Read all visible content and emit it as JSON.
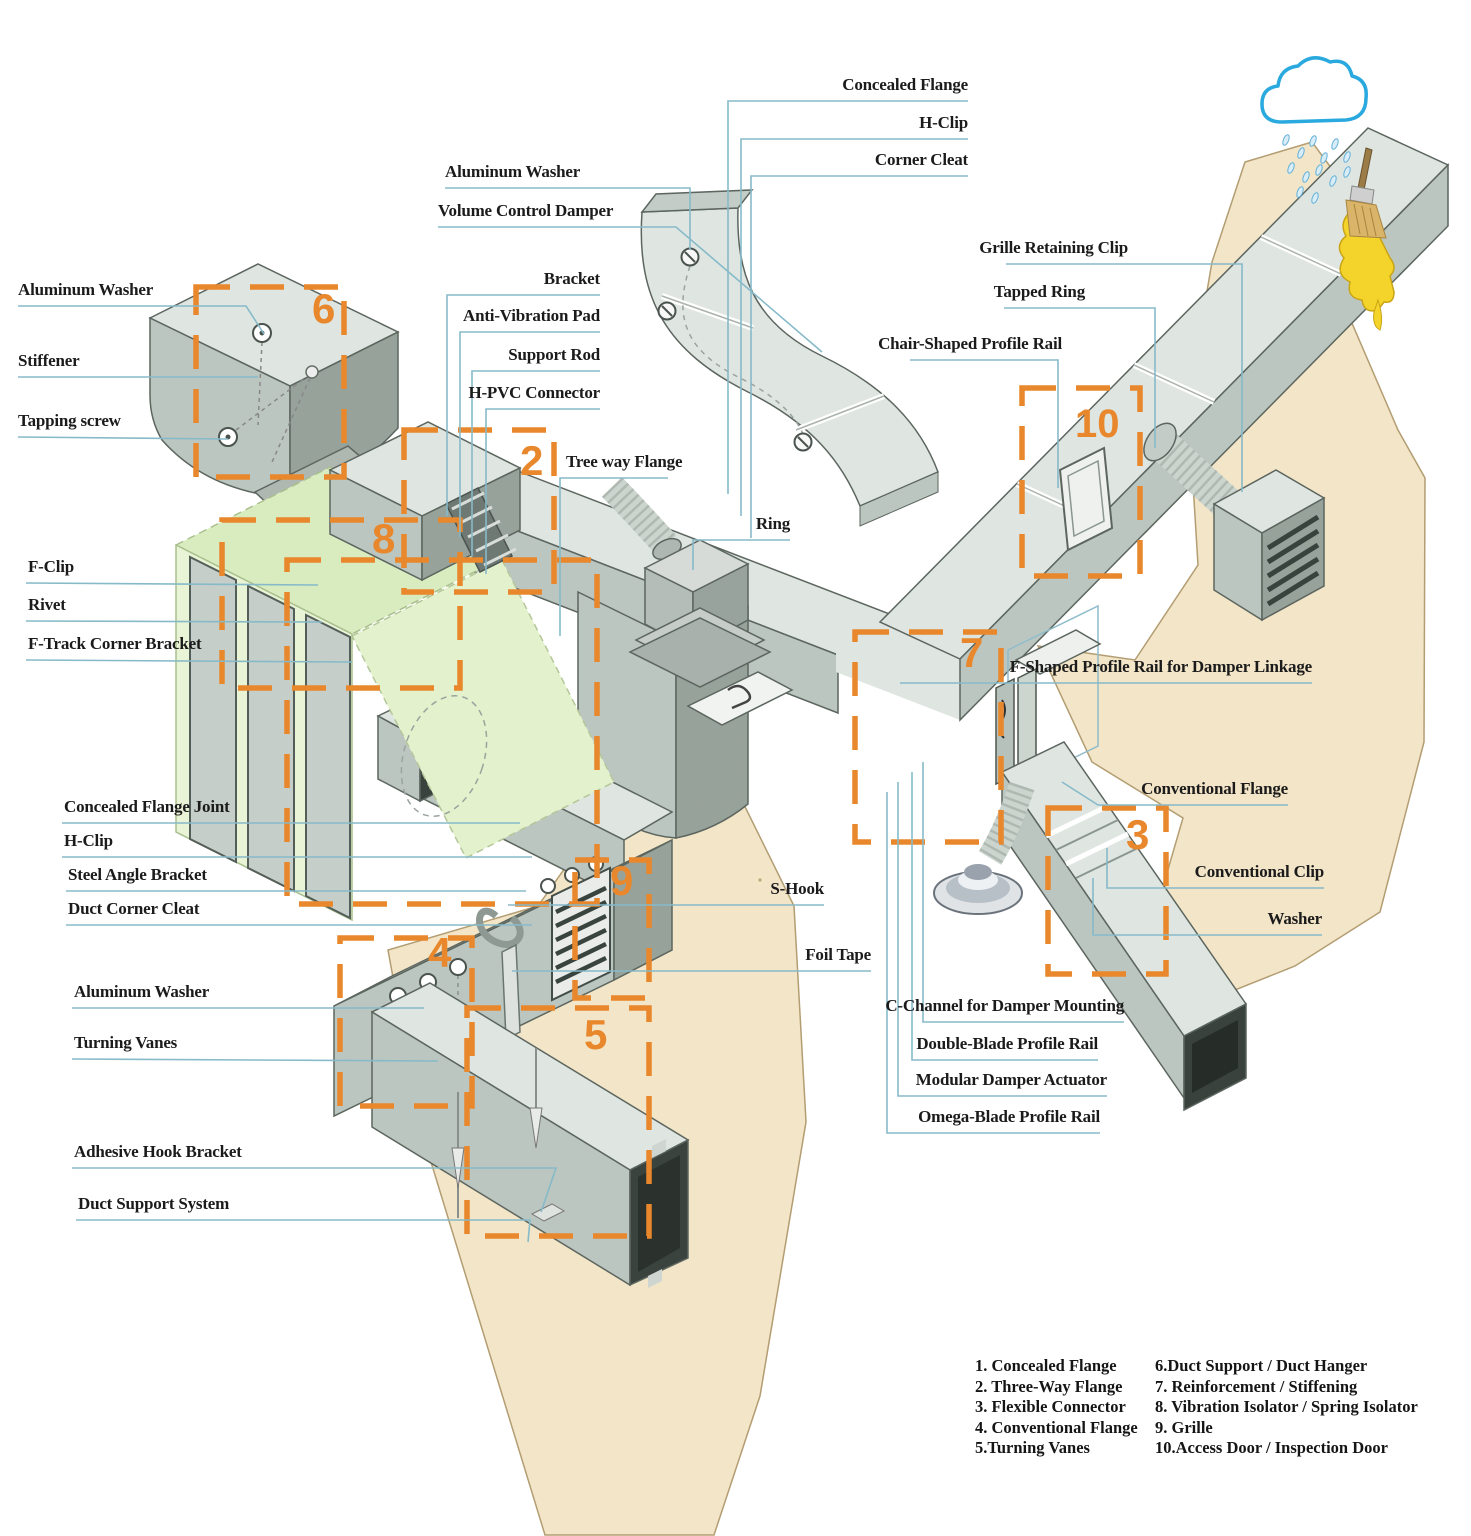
{
  "figure": {
    "kind": "isometric-hvac-duct-assembly-diagram"
  },
  "colors": {
    "leader_line": "#86bac9",
    "callout_box": "#e8872b",
    "label_text": "#1b1b1b",
    "duct_light": "#dfe6e1",
    "duct_mid": "#bcc6c0",
    "duct_dark": "#97a29b",
    "wall_tan": "#f3e5c8",
    "plenum_green": "#d9ecbf",
    "cloud_blue": "#2aa9df",
    "sealant_yellow": "#f4d42a"
  },
  "labels": [
    {
      "id": "aluminum-washer-upper-left",
      "text": "Aluminum Washer"
    },
    {
      "id": "stiffener",
      "text": "Stiffener"
    },
    {
      "id": "tapping-screw",
      "text": "Tapping screw"
    },
    {
      "id": "f-clip",
      "text": "F-Clip"
    },
    {
      "id": "rivet",
      "text": "Rivet"
    },
    {
      "id": "f-track-corner-bracket",
      "text": "F-Track Corner Bracket"
    },
    {
      "id": "concealed-flange-joint",
      "text": "Concealed Flange Joint"
    },
    {
      "id": "h-clip-left",
      "text": "H-Clip"
    },
    {
      "id": "steel-angle-bracket",
      "text": "Steel Angle Bracket"
    },
    {
      "id": "duct-corner-cleat",
      "text": "Duct Corner Cleat"
    },
    {
      "id": "aluminum-washer-lower-left",
      "text": "Aluminum Washer"
    },
    {
      "id": "turning-vanes",
      "text": "Turning Vanes"
    },
    {
      "id": "adhesive-hook-bracket",
      "text": "Adhesive Hook Bracket"
    },
    {
      "id": "duct-support-system",
      "text": "Duct Support System"
    },
    {
      "id": "aluminum-washer-top",
      "text": "Aluminum Washer"
    },
    {
      "id": "volume-control-damper",
      "text": "Volume Control Damper"
    },
    {
      "id": "bracket",
      "text": "Bracket"
    },
    {
      "id": "anti-vibration-pad",
      "text": "Anti-Vibration Pad"
    },
    {
      "id": "support-rod",
      "text": "Support Rod"
    },
    {
      "id": "h-pvc-connector",
      "text": "H-PVC Connector"
    },
    {
      "id": "tree-way-flange",
      "text": "Tree way Flange"
    },
    {
      "id": "ring",
      "text": "Ring"
    },
    {
      "id": "concealed-flange",
      "text": "Concealed Flange"
    },
    {
      "id": "h-clip-top",
      "text": "H-Clip"
    },
    {
      "id": "corner-cleat",
      "text": "Corner Cleat"
    },
    {
      "id": "grille-retaining-clip",
      "text": "Grille Retaining Clip"
    },
    {
      "id": "tapped-ring",
      "text": "Tapped Ring"
    },
    {
      "id": "chair-shaped-profile-rail",
      "text": "Chair-Shaped Profile Rail"
    },
    {
      "id": "f-shaped-profile-rail-for-damper-linkage",
      "text": "F-Shaped Profile Rail for Damper Linkage"
    },
    {
      "id": "conventional-flange",
      "text": "Conventional Flange"
    },
    {
      "id": "conventional-clip",
      "text": "Conventional Clip"
    },
    {
      "id": "washer",
      "text": "Washer"
    },
    {
      "id": "s-hook",
      "text": "S-Hook"
    },
    {
      "id": "foil-tape",
      "text": "Foil Tape"
    },
    {
      "id": "c-channel-for-damper-mounting",
      "text": "C-Channel for Damper Mounting"
    },
    {
      "id": "double-blade-profile-rail",
      "text": "Double-Blade Profile Rail"
    },
    {
      "id": "modular-damper-actuator",
      "text": "Modular Damper Actuator"
    },
    {
      "id": "omega-blade-profile-rail",
      "text": "Omega-Blade Profile Rail"
    }
  ],
  "boxes": [
    {
      "number": "6"
    },
    {
      "number": "2"
    },
    {
      "number": "8"
    },
    {
      "number": "4"
    },
    {
      "number": "5"
    },
    {
      "number": "9"
    },
    {
      "number": "7"
    },
    {
      "number": "10"
    },
    {
      "number": "3"
    }
  ],
  "legend": {
    "left": [
      "1. Concealed Flange",
      "2. Three-Way Flange",
      "3. Flexible Connector",
      "4. Conventional Flange",
      "5.Turning Vanes"
    ],
    "right": [
      "6.Duct Support / Duct Hanger",
      "7. Reinforcement / Stiffening",
      "8. Vibration Isolator / Spring Isolator",
      "9. Grille",
      "10.Access Door / Inspection Door"
    ]
  }
}
